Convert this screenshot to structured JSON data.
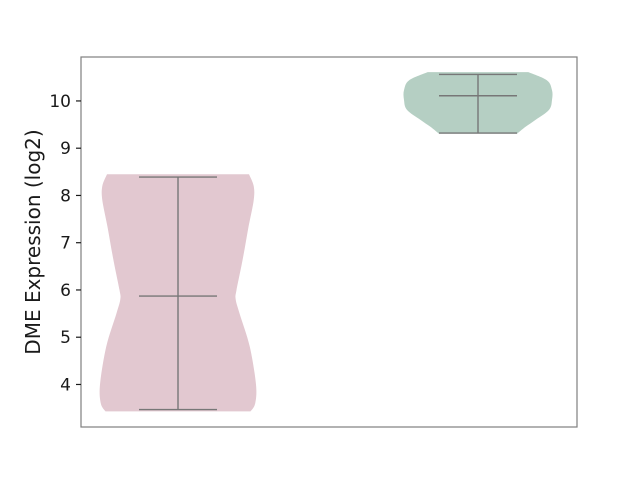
{
  "figure": {
    "width": 640,
    "height": 480,
    "background": "#ffffff"
  },
  "chart_data": {
    "type": "violin",
    "title": "",
    "xlabel": "",
    "ylabel": "DME Expression (log2)",
    "yticks": [
      4,
      5,
      6,
      7,
      8,
      9,
      10
    ],
    "ylim": [
      3.1,
      10.93
    ],
    "grid": "off",
    "legend": "none",
    "x_tick_labels": [],
    "style": {
      "spine_color": "#7f7f7f",
      "tick_color": "#1a1a1a",
      "stat_line_color": "#777777",
      "stat_line_width": 1.4,
      "cap_halfwidth_px": 39
    },
    "plot_area_px": {
      "left": 81,
      "right": 577,
      "top": 57,
      "bottom": 427
    },
    "groups": [
      {
        "name": "group-1",
        "label": "",
        "fill": "#e2c8d0",
        "center_px": 178,
        "max_halfwidth_px": 78,
        "stats": {
          "min": 3.47,
          "median": 5.87,
          "max": 8.39
        },
        "profile": [
          [
            8.45,
            0.91
          ],
          [
            8.2,
            0.97
          ],
          [
            7.9,
            0.97
          ],
          [
            7.3,
            0.9
          ],
          [
            6.65,
            0.83
          ],
          [
            6.0,
            0.75
          ],
          [
            5.8,
            0.74
          ],
          [
            5.5,
            0.79
          ],
          [
            4.8,
            0.92
          ],
          [
            4.0,
            1.0
          ],
          [
            3.6,
            0.99
          ],
          [
            3.43,
            0.93
          ]
        ]
      },
      {
        "name": "group-2",
        "label": "",
        "fill": "#b5cfc3",
        "center_px": 478,
        "max_halfwidth_px": 74,
        "stats": {
          "min": 9.32,
          "median": 10.11,
          "max": 10.56
        },
        "profile": [
          [
            10.61,
            0.68
          ],
          [
            10.44,
            0.93
          ],
          [
            10.23,
            1.0
          ],
          [
            10.02,
            1.0
          ],
          [
            9.81,
            0.96
          ],
          [
            9.6,
            0.78
          ],
          [
            9.45,
            0.64
          ],
          [
            9.31,
            0.53
          ]
        ]
      }
    ]
  }
}
